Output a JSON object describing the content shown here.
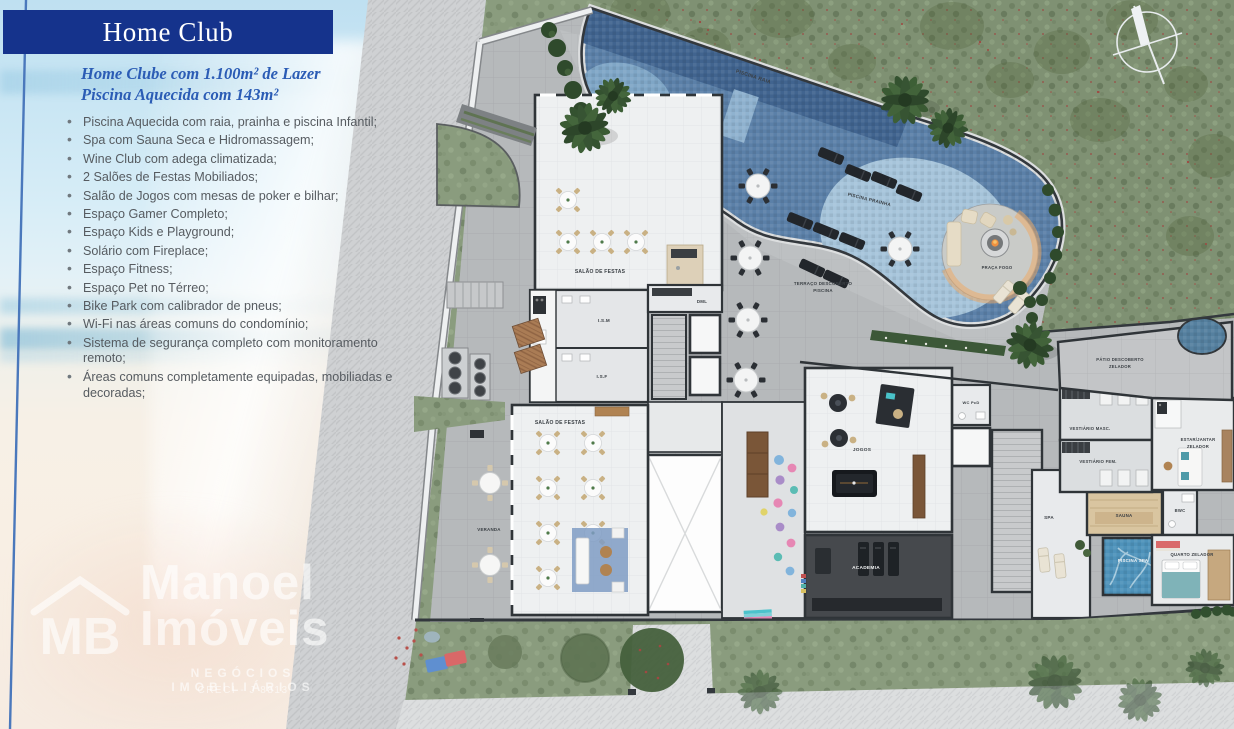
{
  "header": {
    "title": "Home Club"
  },
  "intro": {
    "line1": "Home Clube com 1.100m² de Lazer",
    "line2": "Piscina Aquecida com 143m²"
  },
  "amenities": [
    "Piscina Aquecida com raia, prainha e piscina Infantil;",
    "Spa com Sauna Seca e Hidromassagem;",
    "Wine Club com adega climatizada;",
    "2 Salões de Festas Mobiliados;",
    "Salão de Jogos com mesas de poker e bilhar;",
    "Espaço Gamer Completo;",
    "Espaço Kids e Playground;",
    "Solário com Fireplace;",
    "Espaço Fitness;",
    "Espaço Pet no Térreo;",
    "Bike Park com calibrador de pneus;",
    "Wi-Fi nas áreas comuns do condomínio;",
    "Sistema de segurança completo com monitoramento remoto;",
    "Áreas comuns completamente equipadas, mobiliadas e decoradas;"
  ],
  "watermark": {
    "monogram": "MB",
    "brand_line1": "Manoel",
    "brand_line2": "Imóveis",
    "tagline": "NEGÓCIOS IMOBILIÁRIOS",
    "creci": "CRECI - J 8813"
  },
  "plan": {
    "labels": {
      "piscina_raia": "PISCINA RAIA",
      "piscina_infantil": "PISCINA INFANTIL",
      "piscina_prainha": "PISCINA PRAINHA",
      "terraco_line1": "TERRAÇO DESCOBERTO",
      "terraco_line2": "PISCINA",
      "praca_fogo": "PRAÇA FOGO",
      "salao_festas": "SALÃO DE FESTAS",
      "veranda": "VERANDA",
      "ism": "I.S.M",
      "isf": "I.S.F",
      "dml": "DML",
      "wc_pcd": "WC PcD",
      "jogos": "JOGOS",
      "academia": "ACADEMIA",
      "spa": "SPA",
      "sauna": "SAUNA",
      "piscina_spa": "PISCINA SPA",
      "bwc": "BWC",
      "vestiario_masc": "VESTIÁRIO MASC.",
      "vestiario_fem": "VESTIÁRIO FEM.",
      "estar_line1": "ESTAR/JANTAR",
      "estar_line2": "ZELADOR",
      "quarto_zelador": "QUARTO ZELADOR",
      "patio_line1": "PÁTIO DESCOBERTO",
      "patio_line2": "ZELADOR"
    },
    "colors": {
      "banner_blue": "#15338c",
      "subtitle_blue": "#2b5cb5",
      "pool_lane": "#41648f",
      "pool_main": "#5b80a8",
      "pool_shallow": "#a6c4da",
      "grass": "#8a9c7e",
      "terrace_gray": "#b6b9bb"
    }
  }
}
